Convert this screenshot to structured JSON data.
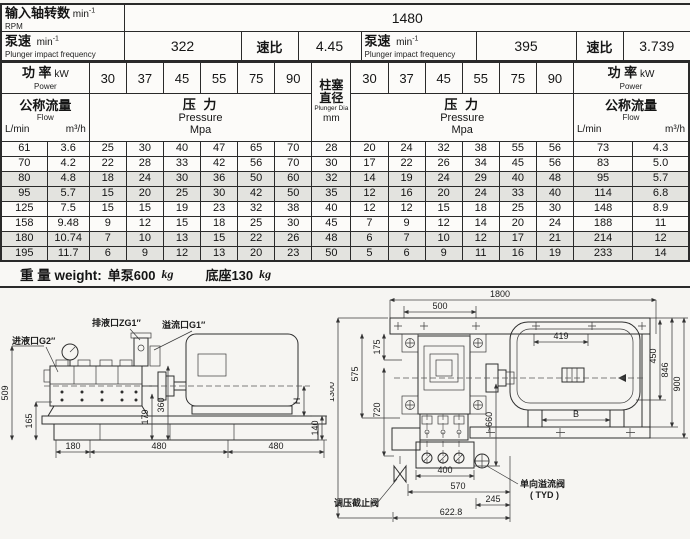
{
  "title_table": {
    "rpm_cn": "输入轴转数",
    "rpm_unit": "min",
    "rpm_sup": "-1",
    "rpm_en": "RPM",
    "rpm_value": "1480",
    "pump_speed_cn": "泵速",
    "pump_speed_unit": "min",
    "pump_speed_sup": "-1",
    "pump_speed_en": "Plunger impact frequency",
    "speed_left": "322",
    "ratio_label": "速比",
    "ratio_left": "4.45",
    "speed_right": "395",
    "ratio_right": "3.739"
  },
  "spec_table": {
    "power_label_cn": "功 率",
    "power_unit": "kW",
    "power_en": "Power",
    "power_values": [
      "30",
      "37",
      "45",
      "55",
      "75",
      "90"
    ],
    "plunger": {
      "cn1": "柱塞",
      "cn2": "直径",
      "en": "Plunger Dia",
      "unit": "mm"
    },
    "flow": {
      "cn": "公称流量",
      "en": "Flow",
      "unit1": "L/min",
      "unit2": "m³/h"
    },
    "pressure": {
      "cn": "压 力",
      "en": "Pressure",
      "unit": "Mpa"
    },
    "rows": [
      [
        "61",
        "3.6",
        "25",
        "30",
        "40",
        "47",
        "65",
        "70",
        "28",
        "20",
        "24",
        "32",
        "38",
        "55",
        "56",
        "73",
        "4.3"
      ],
      [
        "70",
        "4.2",
        "22",
        "28",
        "33",
        "42",
        "56",
        "70",
        "30",
        "17",
        "22",
        "26",
        "34",
        "45",
        "56",
        "83",
        "5.0"
      ],
      [
        "80",
        "4.8",
        "18",
        "24",
        "30",
        "36",
        "50",
        "60",
        "32",
        "14",
        "19",
        "24",
        "29",
        "40",
        "48",
        "95",
        "5.7"
      ],
      [
        "95",
        "5.7",
        "15",
        "20",
        "25",
        "30",
        "42",
        "50",
        "35",
        "12",
        "16",
        "20",
        "24",
        "33",
        "40",
        "114",
        "6.8"
      ],
      [
        "125",
        "7.5",
        "15",
        "15",
        "19",
        "23",
        "32",
        "38",
        "40",
        "12",
        "12",
        "15",
        "18",
        "25",
        "30",
        "148",
        "8.9"
      ],
      [
        "158",
        "9.48",
        "9",
        "12",
        "15",
        "18",
        "25",
        "30",
        "45",
        "7",
        "9",
        "12",
        "14",
        "20",
        "24",
        "188",
        "11"
      ],
      [
        "180",
        "10.74",
        "7",
        "10",
        "13",
        "15",
        "22",
        "26",
        "48",
        "6",
        "7",
        "10",
        "12",
        "17",
        "21",
        "214",
        "12"
      ],
      [
        "195",
        "11.7",
        "6",
        "9",
        "12",
        "13",
        "20",
        "23",
        "50",
        "5",
        "6",
        "9",
        "11",
        "16",
        "19",
        "233",
        "14"
      ]
    ],
    "shaded_row_indices": [
      2,
      3,
      6,
      7
    ]
  },
  "weight_note": {
    "label": "重 量 weight:",
    "pump": "单泵600",
    "pump_unit": "kg",
    "base": "底座130",
    "base_unit": "kg"
  },
  "drawings": {
    "left": {
      "ports": {
        "inlet": "进液口G2″",
        "discharge": "排液口ZG1″",
        "overflow": "溢流口G1″"
      },
      "dims": {
        "d509": "509",
        "d165": "165",
        "d179": "179",
        "d360": "360",
        "dH": "H",
        "d140": "140",
        "d180": "180",
        "d480a": "480",
        "d480b": "480"
      }
    },
    "right": {
      "dims": {
        "overall": "1800",
        "top": "500",
        "motor": "419",
        "v175": "175",
        "v575": "575",
        "v1300": "1300",
        "v720": "720",
        "v660": "~660",
        "v450": "450",
        "v846": "846",
        "v900": "900",
        "footB": "B",
        "w400": "400",
        "w570": "570",
        "w245": "245",
        "w6228": "622.8"
      },
      "labels": {
        "check_valve": "单向溢流阀",
        "check_valve2": "( TYD )",
        "stop_valve": "调压截止阀"
      }
    }
  }
}
